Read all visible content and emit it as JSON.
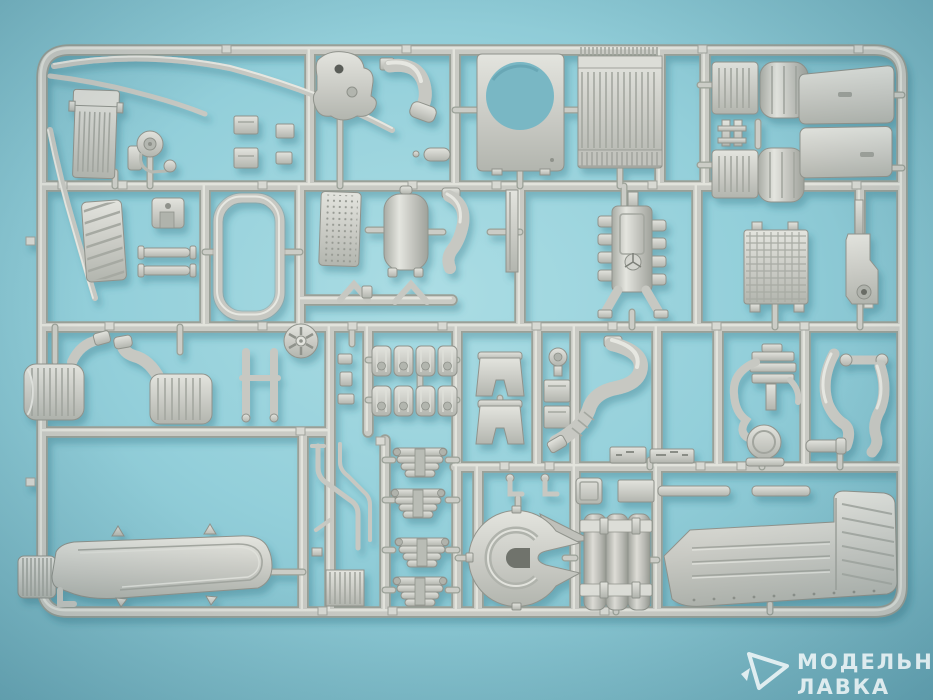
{
  "scene": {
    "type": "photograph",
    "subject": "Injection-molded plastic model kit sprue (runner) with light gray truck engine and chassis parts, photographed on a light blue textured background"
  },
  "sprue": {
    "material_color_name": "light gray",
    "parts": [
      "long trim blade",
      "short trim blade",
      "side trim strip",
      "intercooler radiator",
      "fan pulley with belt",
      "small mounting brackets",
      "transfer case casting",
      "exhaust elbow",
      "oval cover",
      "fan shroud panel",
      "radiator with comb header",
      "fuel tank with battery box (upper)",
      "fuel tank with battery box (lower)",
      "frame connector",
      "radiator grille panel",
      "engine mount block",
      "link rods",
      "door window seal frame",
      "perforated heat shield",
      "air reservoir tank",
      "exhaust downpipe",
      "channel strip",
      "V-linkages",
      "V8 engine block with star emblem",
      "radiator core",
      "chassis bracket",
      "air cleaner canister (small)",
      "air cleaner canister (large)",
      "engine support H-frame",
      "cooling fan wheel",
      "small fittings",
      "gearbox blocks",
      "engine mount brackets",
      "round cap",
      "cover plates",
      "exhaust S-pipe",
      "air compressor with round canister",
      "coolant hose pair",
      "long side muffler with ribbed cap",
      "torsion rods",
      "coil rib block",
      "leaf springs",
      "fifth wheel coupling",
      "corrugated tank panel with straps",
      "mounting rails",
      "battery step panel",
      "embossed brand stamp",
      "part number tags"
    ]
  },
  "watermark": {
    "line1": "МОДЕЛЬНАЯ",
    "line2": "ЛАВКА",
    "logo": "paper-plane-triangle-icon"
  },
  "palette": {
    "background_center": "#abdde4",
    "background_edge": "#6dadbc",
    "plastic_highlight": "#e9e9e4",
    "plastic_base": "#c9cac4",
    "plastic_shadow": "#90938c",
    "cast_shadow": "#3a7486",
    "watermark": "rgba(255,255,255,0.78)"
  }
}
